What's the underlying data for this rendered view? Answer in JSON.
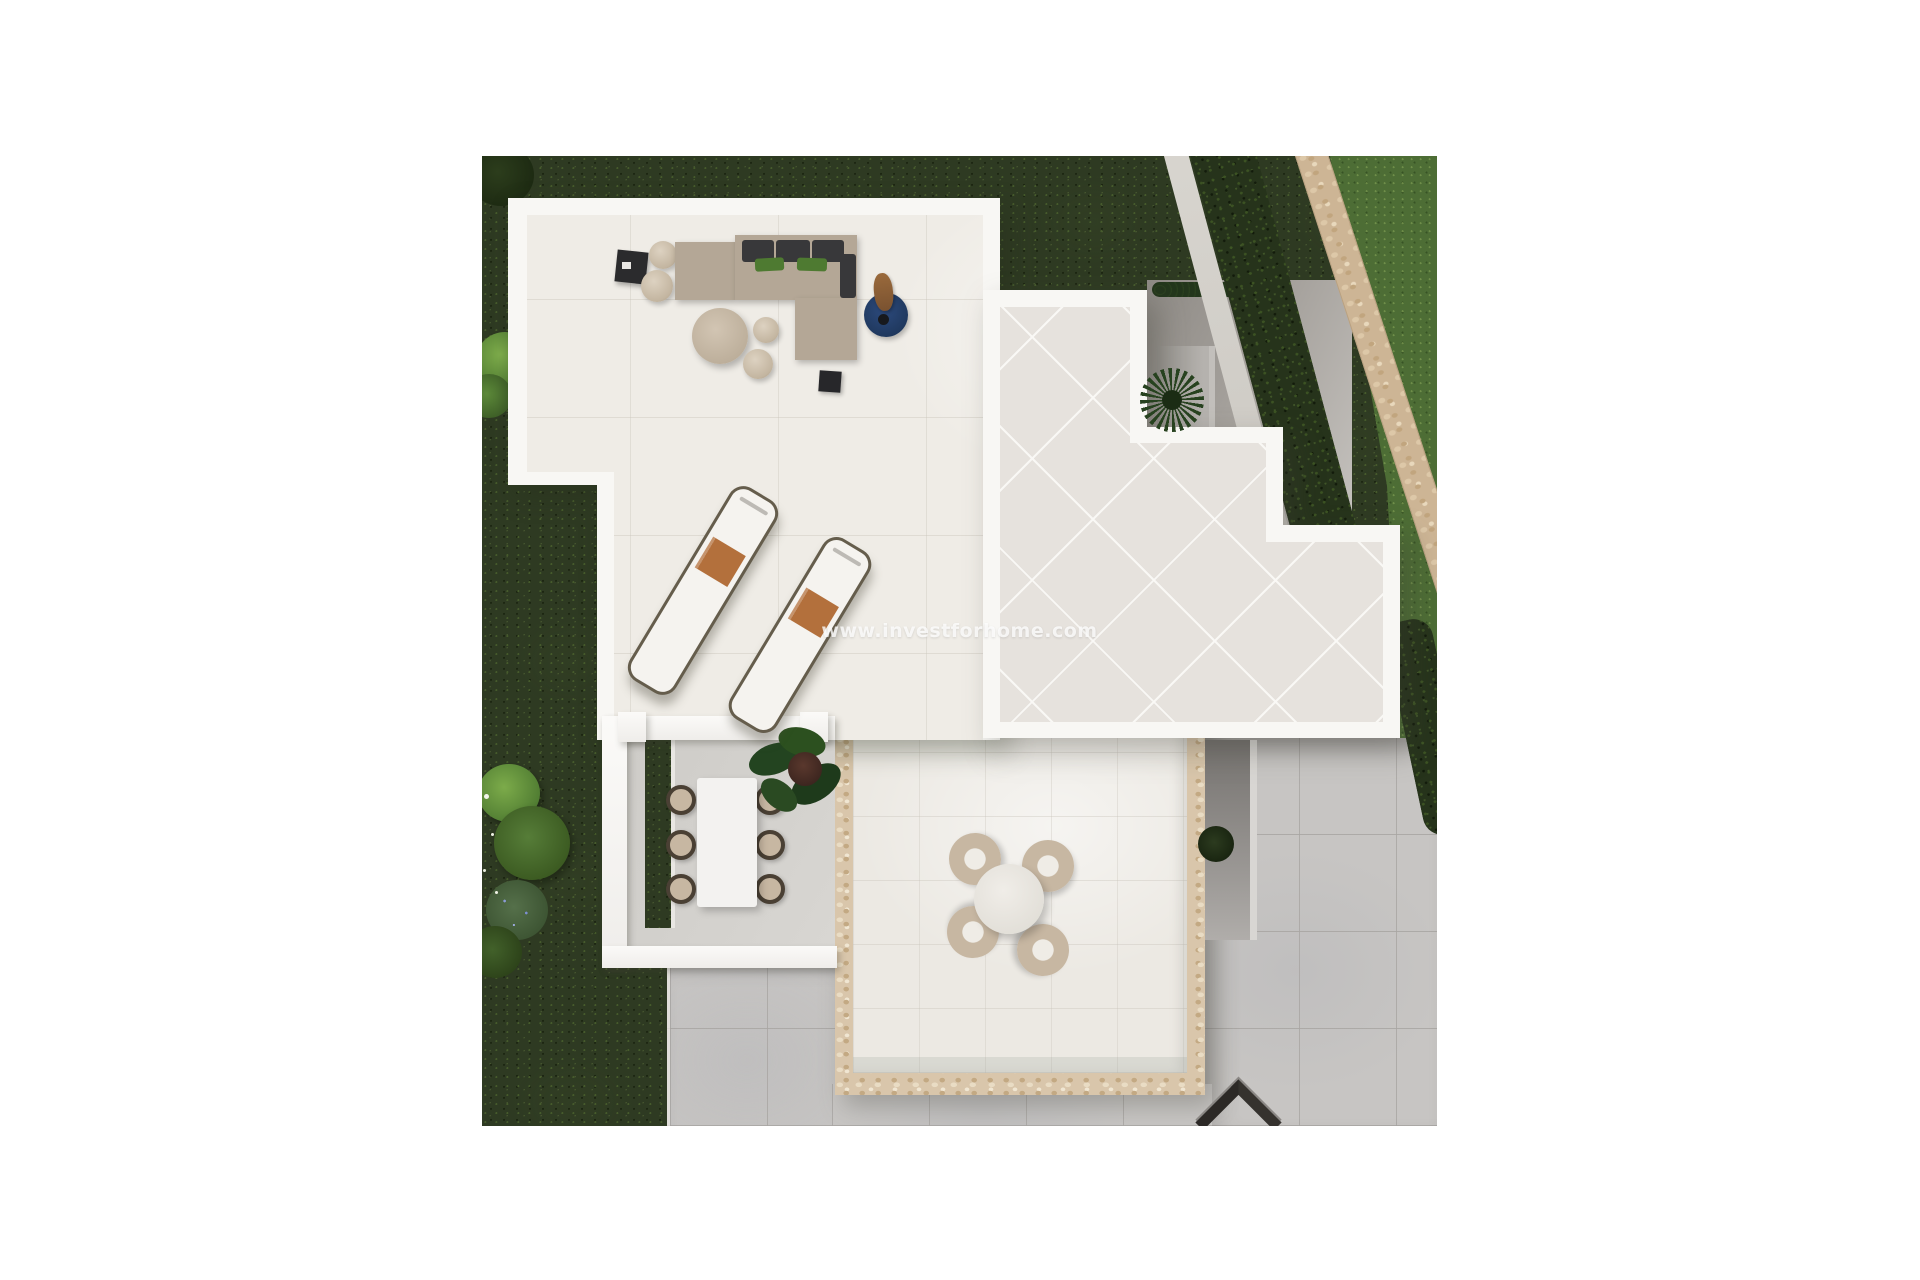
{
  "page": {
    "background_color": "#ffffff"
  },
  "photo": {
    "watermark": "www.investforhome.com",
    "description": "Aerial 3D render of a modern villa: garden lawn with bushes and hedge, stone boundary wall, white roof terraces with lounge sofa set, two sun loungers, pergola dining area with table for six, and a lower patio with round table for four beside grey paving.",
    "palette": {
      "page_bg": "#ffffff",
      "grass_dark": "#2e3a22",
      "grass_bright": "#4d6d35",
      "hedge": "#26331b",
      "stone_path": "#cdb595",
      "stone_border": "#d9c6ab",
      "wall_white": "#f8f7f4",
      "terrace_floor": "#efece6",
      "diagonal_floor": "#e6e2dd",
      "lower_floor": "#ece9e3",
      "paving": "#c7c5c3",
      "courtyard": "#a19d98",
      "pergola_floor": "#d3d1cd",
      "sofa": "#b4a796",
      "cushion_dark": "#38383a",
      "cushion_green": "#4e7a31",
      "towel": "#b3703c",
      "rug_blue": "#2c4a7d",
      "furniture_beige": "#c7b7a2",
      "table_white": "#f3f2f0"
    }
  }
}
